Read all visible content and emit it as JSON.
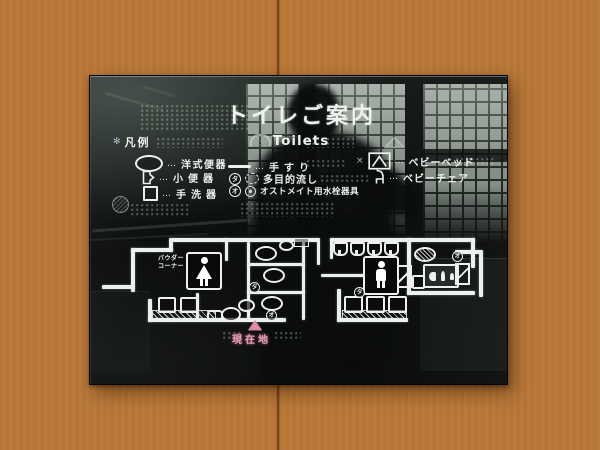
{
  "sign": {
    "title": "トイレご案内",
    "subtitle": "Toilets",
    "legend": {
      "heading": "凡例",
      "leader": "…",
      "marker_glyph": "✻",
      "x_glyph": "×",
      "left": [
        {
          "icon": "western-toilet-icon",
          "label": "洋式便器"
        },
        {
          "icon": "urinal-icon",
          "label": "小便器"
        },
        {
          "icon": "hand-basin-icon",
          "label": "手洗器"
        }
      ],
      "middle": [
        {
          "icon": "handrail-icon",
          "label": "手すり"
        },
        {
          "icon": "multipurpose-sink-icon",
          "badge": "タ",
          "label": "多目的流し"
        },
        {
          "icon": "ostomate-fixture-icon",
          "badge": "オ",
          "label": "オストメイト用水栓器具"
        }
      ],
      "right": [
        {
          "icon": "baby-bed-icon",
          "label": "ベビーベッド"
        },
        {
          "icon": "baby-chair-icon",
          "label": "ベビーチェア"
        }
      ]
    },
    "map": {
      "powder_corner": [
        "パウダー",
        "コーナー"
      ],
      "current_location": "現在地",
      "badges": {
        "ta": "タ",
        "o": "オ"
      }
    },
    "colors": {
      "wall_wood": "#c68342",
      "panel_black": "#0d100f",
      "ink_white": "#eef2ee",
      "location_pink": "#df93a8",
      "reflection_gray": "#b2bdb3"
    }
  }
}
